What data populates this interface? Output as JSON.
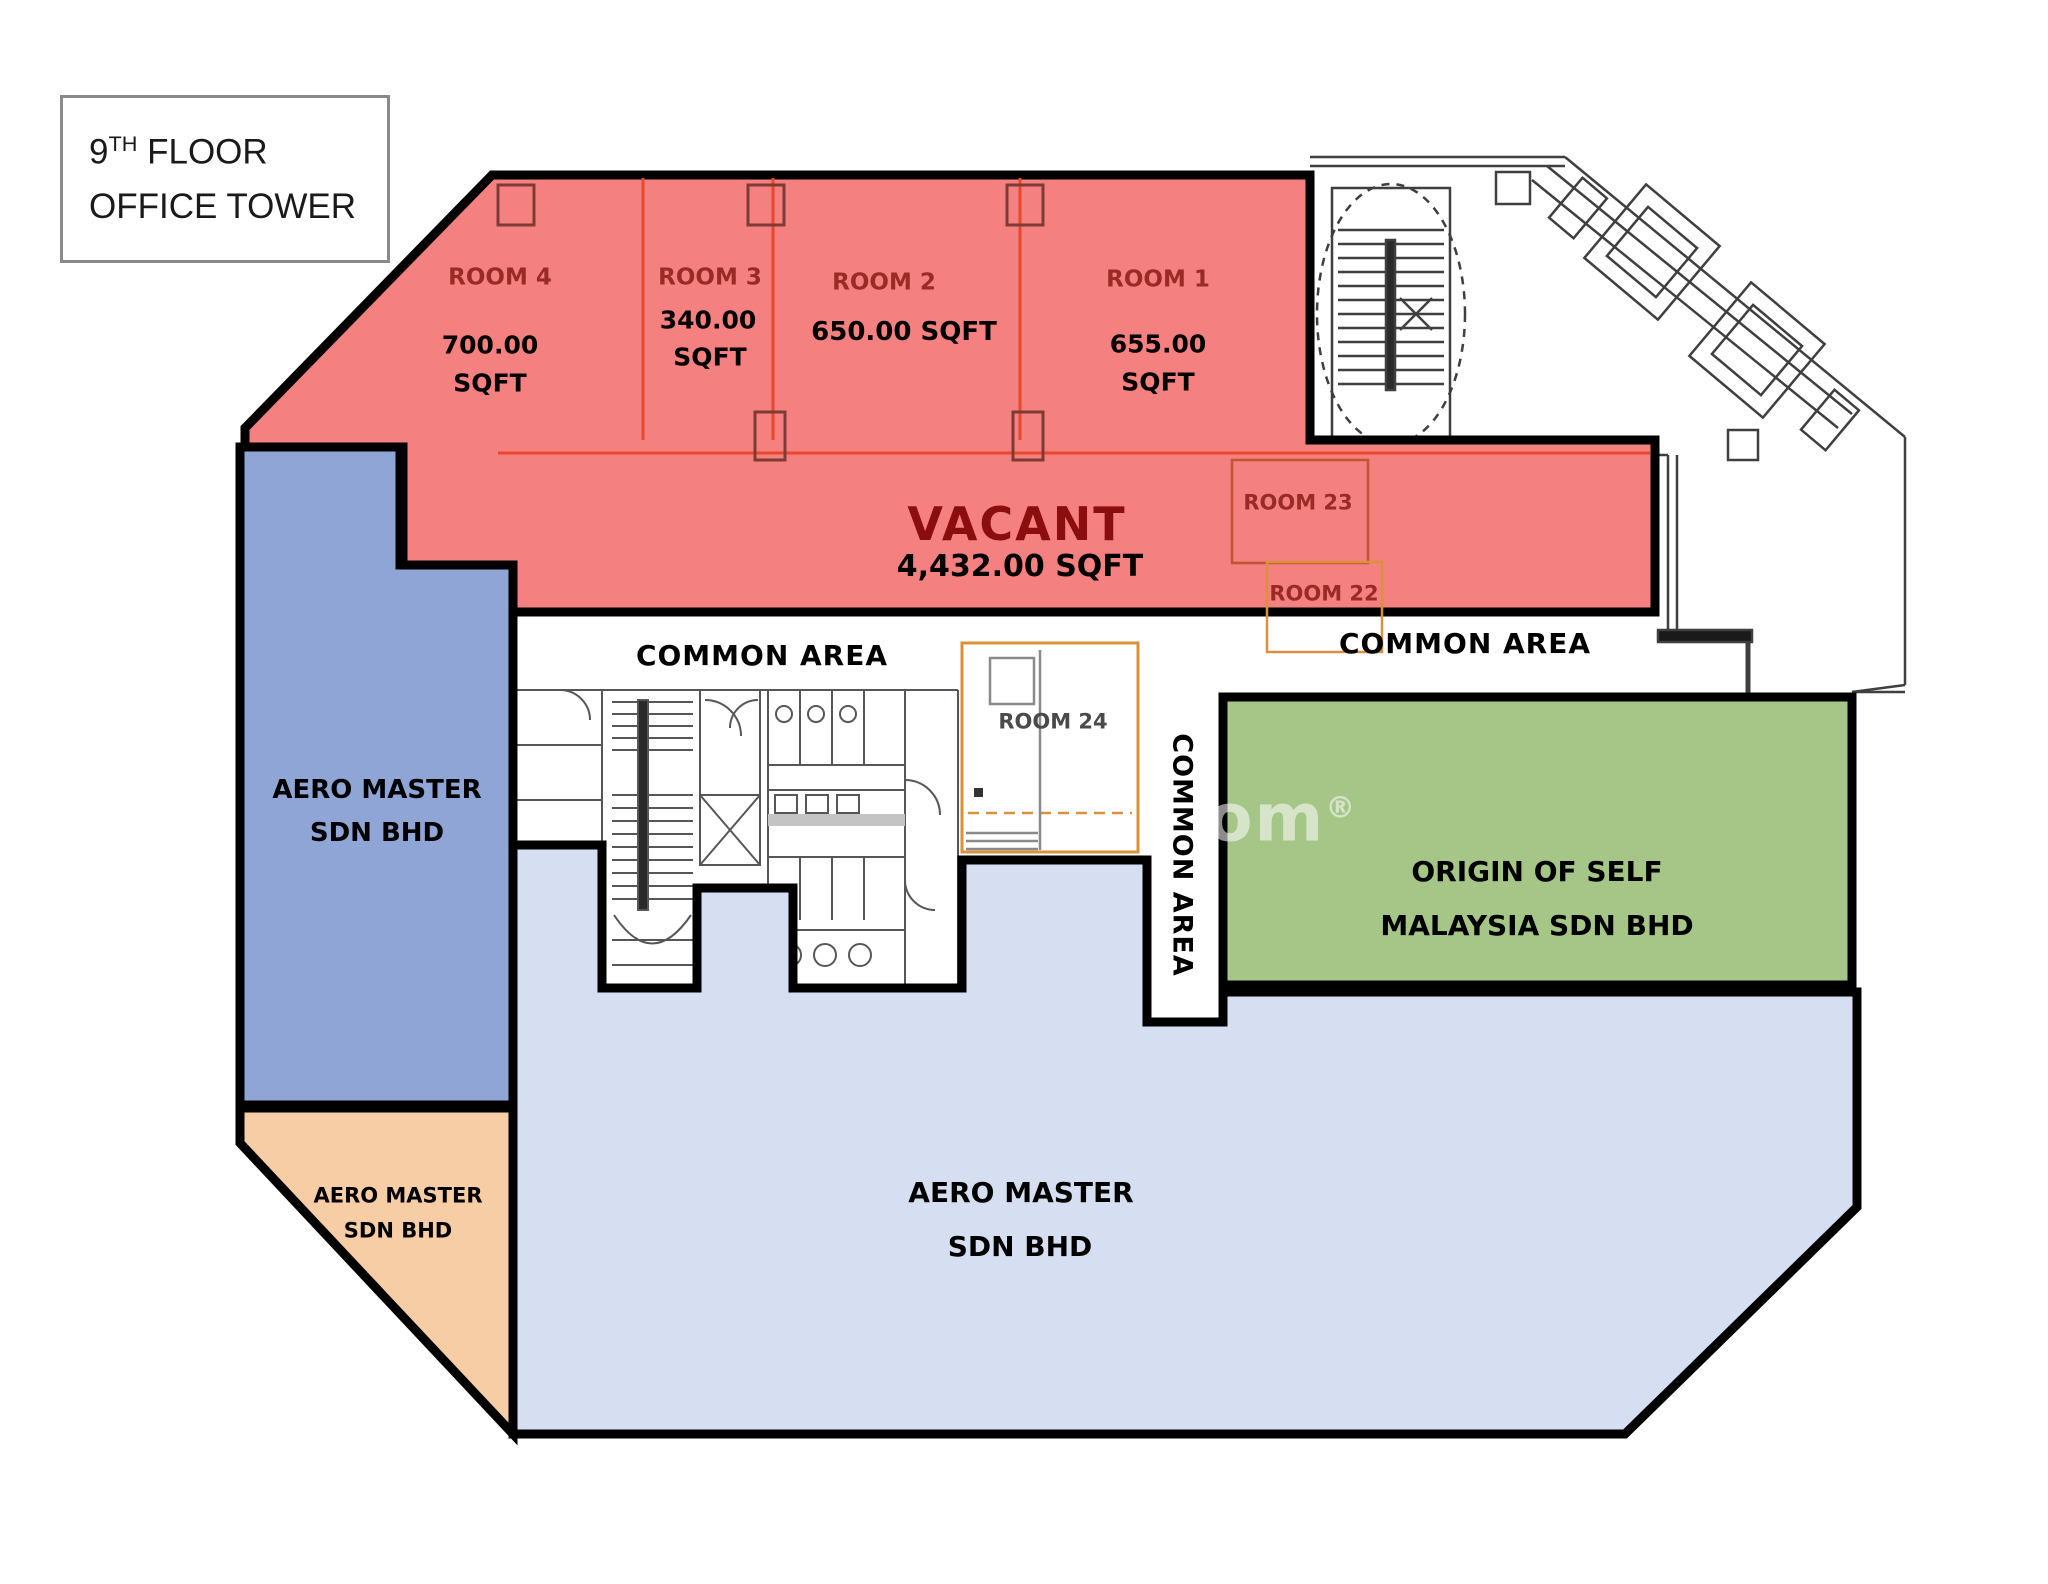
{
  "title": {
    "line1_base": "9",
    "line1_sup": "TH",
    "line1_rest": " FLOOR",
    "line2": "OFFICE TOWER"
  },
  "rooms": {
    "room4": {
      "name": "ROOM 4",
      "area_line1": "700.00",
      "area_line2": "SQFT"
    },
    "room3": {
      "name": "ROOM 3",
      "area_line1": "340.00",
      "area_line2": "SQFT"
    },
    "room2": {
      "name": "ROOM 2",
      "area": "650.00 SQFT"
    },
    "room1": {
      "name": "ROOM 1",
      "area_line1": "655.00",
      "area_line2": "SQFT"
    },
    "room23": {
      "name": "ROOM 23"
    },
    "room22": {
      "name": "ROOM 22"
    },
    "room24": {
      "name": "ROOM 24"
    }
  },
  "vacant": {
    "label": "VACANT",
    "area": "4,432.00 SQFT"
  },
  "common_areas": {
    "left": "COMMON AREA",
    "right": "COMMON AREA",
    "vertical": "COMMON AREA"
  },
  "tenants": {
    "aero_left": {
      "line1": "AERO MASTER",
      "line2": "SDN BHD"
    },
    "aero_bottom": {
      "line1": "AERO MASTER",
      "line2": "SDN BHD"
    },
    "aero_peach": {
      "line1": "AERO MASTER",
      "line2": "SDN BHD"
    },
    "origin": {
      "line1": "ORIGIN OF SELF",
      "line2": "MALAYSIA SDN BHD"
    }
  },
  "watermark": {
    "text": ".com",
    "reg": "®"
  },
  "colors": {
    "vacant_fill": "#F58080",
    "tenant_blue": "#8FA5D6",
    "tenant_light_blue": "#D6DFF1",
    "tenant_peach": "#F6CDA5",
    "tenant_green": "#A5C687",
    "room_label": "#992B26",
    "vacant_label": "#8B0E0E",
    "thin_red_line": "#E8482E",
    "orange_box": "#D9923B",
    "red_box": "#C25432",
    "outline": "#000000"
  }
}
